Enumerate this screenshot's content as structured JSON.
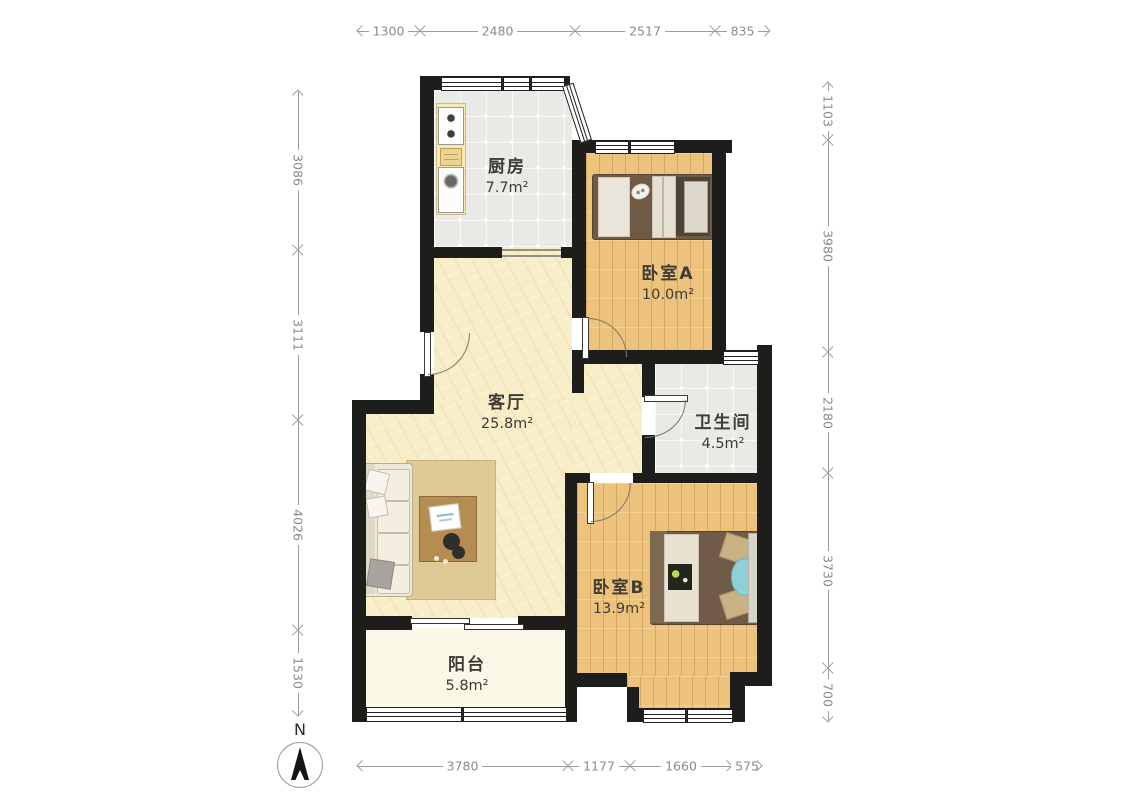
{
  "rooms": [
    {
      "name": "厨房",
      "area": "7.7m²"
    },
    {
      "name": "卧室A",
      "area": "10.0m²"
    },
    {
      "name": "客厅",
      "area": "25.8m²"
    },
    {
      "name": "卫生间",
      "area": "4.5m²"
    },
    {
      "name": "卧室B",
      "area": "13.9m²"
    },
    {
      "name": "阳台",
      "area": "5.8m²"
    }
  ],
  "dimensions": {
    "top": [
      "1300",
      "2480",
      "2517",
      "835"
    ],
    "left": [
      "3086",
      "3111",
      "4026",
      "1530"
    ],
    "right": [
      "1103",
      "3980",
      "2180",
      "3730",
      "700"
    ],
    "bottom": [
      "3780",
      "1177",
      "1660",
      "575"
    ]
  },
  "compass": {
    "label": "N"
  },
  "colors": {
    "wall": "#1d1d1b",
    "wood_floor": "#edc27c",
    "tile_floor": "#e9e9e6",
    "living_floor": "#f7eec8",
    "balcony_floor": "#fbf8e8",
    "dimension_line": "#9c9c9c",
    "bed_duvet": "#6f5b47",
    "accent_blue": "#8fd0d8"
  }
}
